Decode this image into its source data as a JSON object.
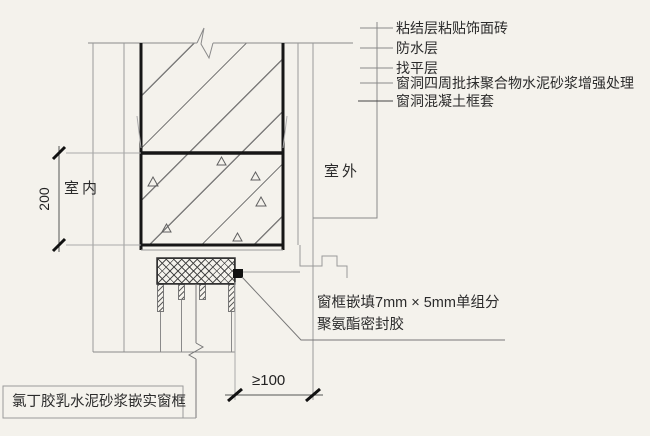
{
  "diagram": {
    "room_left": "室内",
    "room_right": "室外",
    "dim_vertical": "200",
    "dim_horizontal": "≥100",
    "layer_labels": [
      "粘结层粘贴饰面砖",
      "防水层",
      "找平层",
      "窗洞四周批抹聚合物水泥砂浆增强处理",
      "窗洞混凝土框套"
    ],
    "sealant_label": {
      "line1": "窗框嵌填7mm × 5mm单组分",
      "line2": "聚氨酯密封胶"
    },
    "frame_label": "氯丁胶乳水泥砂浆嵌实窗框"
  },
  "colors": {
    "line_thin": "#8a8a8a",
    "line_thick": "#161616",
    "text": "#2b2b2b",
    "background": "#f4f2ec"
  }
}
